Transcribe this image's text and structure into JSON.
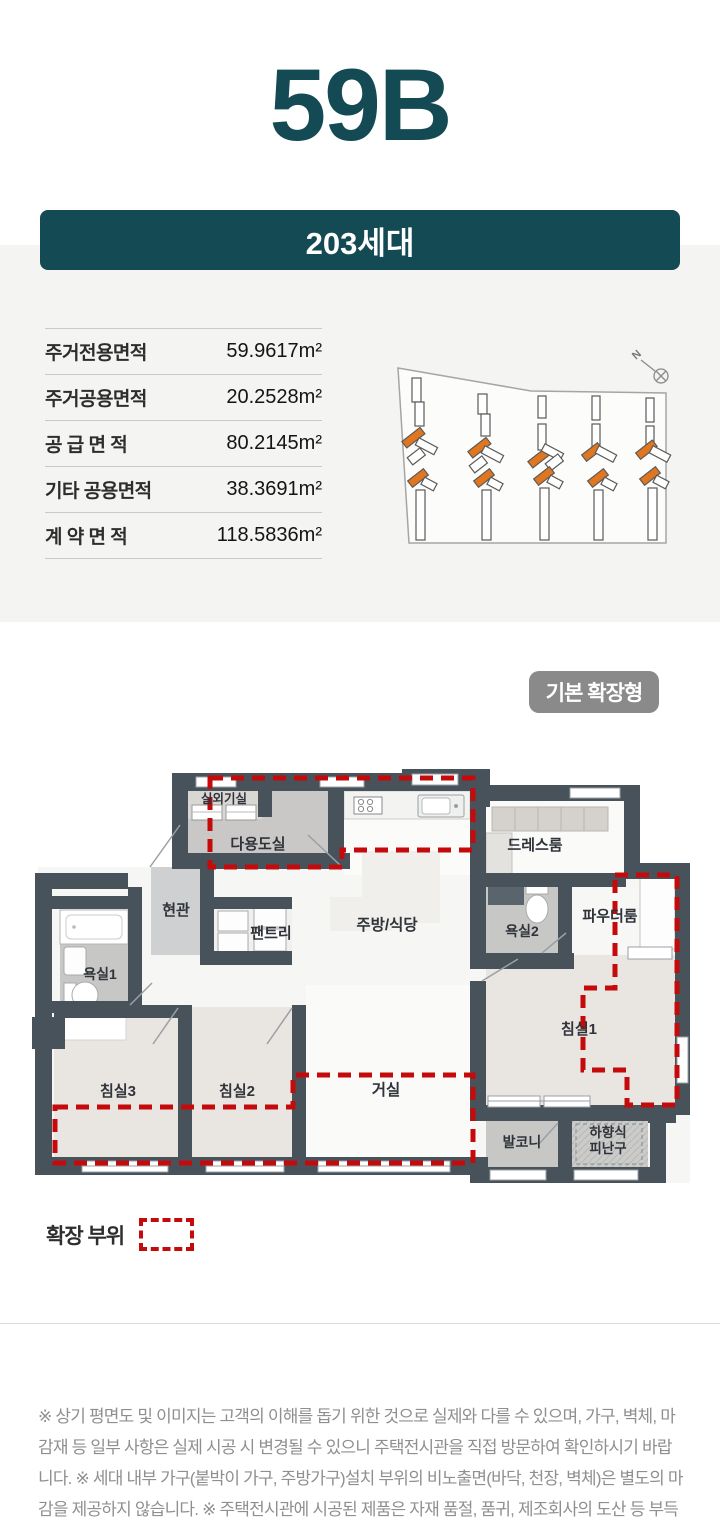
{
  "colors": {
    "accent_teal": "#144a53",
    "badge_gray": "#8a8a8a",
    "extension_red": "#c40a0a",
    "wall_dark": "#48525a",
    "building_highlight_orange": "#e0761f"
  },
  "header": {
    "unit_name": "59B",
    "households": "203세대"
  },
  "area_table": {
    "rows": [
      {
        "label": "주거전용면적",
        "value": "59.9617m²"
      },
      {
        "label": "주거공용면적",
        "value": "20.2528m²"
      },
      {
        "label": "공 급 면 적",
        "value": "80.2145m²"
      },
      {
        "label": "기타 공용면적",
        "value": "38.3691m²"
      },
      {
        "label": "계 약 면 적",
        "value": "118.5836m²"
      }
    ]
  },
  "site_plan": {
    "north_label": "N"
  },
  "floor_plan": {
    "type_badge": "기본 확장형",
    "rooms": [
      {
        "id": "outdoor-unit-room",
        "label": "실외기실"
      },
      {
        "id": "utility-room",
        "label": "다용도실"
      },
      {
        "id": "dress-room",
        "label": "드레스룸"
      },
      {
        "id": "entrance",
        "label": "현관"
      },
      {
        "id": "pantry",
        "label": "팬트리"
      },
      {
        "id": "kitchen-dining",
        "label": "주방/식당"
      },
      {
        "id": "bathroom2",
        "label": "욕실2"
      },
      {
        "id": "powder-room",
        "label": "파우더룸"
      },
      {
        "id": "bathroom1",
        "label": "욕실1"
      },
      {
        "id": "bedroom3",
        "label": "침실3"
      },
      {
        "id": "bedroom2",
        "label": "침실2"
      },
      {
        "id": "living-room",
        "label": "거실"
      },
      {
        "id": "bedroom1",
        "label": "침실1"
      },
      {
        "id": "balcony",
        "label": "발코니"
      },
      {
        "id": "escape-hatch-line1",
        "label": "하향식"
      },
      {
        "id": "escape-hatch-line2",
        "label": "피난구"
      }
    ]
  },
  "legend": {
    "label": "확장 부위"
  },
  "footer": {
    "disclaimer": "※ 상기 평면도 및 이미지는 고객의 이해를 돕기 위한 것으로 실제와 다를 수 있으며, 가구, 벽체, 마감재 등 일부 사항은 실제 시공 시 변경될 수 있으니 주택전시관을 직접 방문하여 확인하시기 바랍니다. ※ 세대 내부 가구(붙박이 가구, 주방가구)설치 부위의 비노출면(바닥, 천장, 벽체)은 별도의 마감을 제공하지 않습니다. ※ 주택전시관에 시공된 제품은 자재 품절, 품귀, 제조회사의 도산 등 부득이한 경우에 한하여 동급 이상의 제품이나 타사 제품으로 변경될 수 있습니다."
  }
}
